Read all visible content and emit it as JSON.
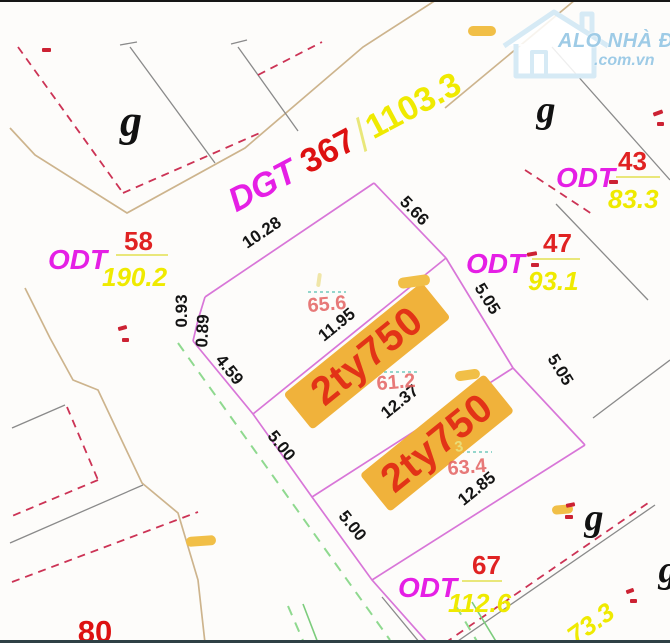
{
  "canvas": {
    "width": 670,
    "height": 643
  },
  "colors": {
    "parcel_code": "#e51fe5",
    "parcel_number": "#e02222",
    "parcel_area": "#efea00",
    "dimension_text": "#141414",
    "plot_line": "#d876d8",
    "road_line": "#cdb48d",
    "boundary_gray": "#8a8a8a",
    "red_dashed": "#cc3355",
    "green_survey": "#8fd98f",
    "teal_tick": "#72c9bd",
    "price_tag_bg": "#f0b23b",
    "price_tag_text": "#e23317",
    "watermark_blue": "#9ecbe6"
  },
  "watermark": {
    "brand": "ALO NHÀ ĐẤT",
    "domain": ".com.vn"
  },
  "road": {
    "code": "DGT",
    "number": "367",
    "area": "1103.3"
  },
  "parcels": [
    {
      "code": "ODT",
      "number": "58",
      "area": "190.2",
      "x": 48,
      "y": 244,
      "nx": 76,
      "ny": -18,
      "bx": 68,
      "by": 10,
      "bw": 52,
      "ax": 54,
      "ay": 18
    },
    {
      "code": "ODT",
      "number": "47",
      "area": "93.1",
      "x": 466,
      "y": 248,
      "nx": 77,
      "ny": -20,
      "bx": 66,
      "by": 10,
      "bw": 48,
      "ax": 62,
      "ay": 18
    },
    {
      "code": "ODT",
      "number": "43",
      "area": "83.3",
      "x": 556,
      "y": 162,
      "nx": 62,
      "ny": -16,
      "bx": 60,
      "by": 14,
      "bw": 44,
      "ax": 52,
      "ay": 22
    },
    {
      "code": "ODT",
      "number": "67",
      "area": "112.6",
      "x": 398,
      "y": 572,
      "nx": 74,
      "ny": -22,
      "bx": 64,
      "by": 8,
      "bw": 40,
      "ax": 50,
      "ay": 16
    }
  ],
  "price_tags": [
    {
      "label": "2ty750",
      "x": 367,
      "y": 356,
      "r": -39,
      "w": 178,
      "h": 46
    },
    {
      "label": "2ty750",
      "x": 437,
      "y": 443,
      "r": -39,
      "w": 160,
      "h": 48
    }
  ],
  "plot_areas": [
    {
      "v": "65.6",
      "x": 327,
      "y": 305,
      "r": -5
    },
    {
      "v": "61.2",
      "x": 396,
      "y": 383,
      "r": -5
    },
    {
      "v": "63.4",
      "x": 467,
      "y": 468,
      "r": -5
    }
  ],
  "dimensions": [
    {
      "v": "10.28",
      "x": 262,
      "y": 233,
      "r": -34
    },
    {
      "v": "5.66",
      "x": 414,
      "y": 211,
      "r": 46
    },
    {
      "v": "5.05",
      "x": 487,
      "y": 299,
      "r": 58
    },
    {
      "v": "5.05",
      "x": 560,
      "y": 370,
      "r": 58
    },
    {
      "v": "0.93",
      "x": 182,
      "y": 311,
      "r": -90
    },
    {
      "v": "0.89",
      "x": 203,
      "y": 331,
      "r": -87
    },
    {
      "v": "4.59",
      "x": 229,
      "y": 370,
      "r": 51
    },
    {
      "v": "5.00",
      "x": 281,
      "y": 446,
      "r": 51
    },
    {
      "v": "5.00",
      "x": 352,
      "y": 526,
      "r": 51
    },
    {
      "v": "11.95",
      "x": 337,
      "y": 325,
      "r": -39
    },
    {
      "v": "12.37",
      "x": 400,
      "y": 402,
      "r": -39
    },
    {
      "v": "12.85",
      "x": 477,
      "y": 489,
      "r": -39
    }
  ],
  "zone_letters": [
    {
      "v": "g",
      "x": 131,
      "y": 121,
      "s": 44
    },
    {
      "v": "g",
      "x": 546,
      "y": 110,
      "s": 38
    },
    {
      "v": "g",
      "x": 594,
      "y": 518,
      "s": 38
    },
    {
      "v": "g",
      "x": 668,
      "y": 570,
      "s": 38
    }
  ],
  "misc_labels": [
    {
      "v": "73.3",
      "x": 591,
      "y": 624,
      "r": -36,
      "cls": "ylabel"
    },
    {
      "v": "80",
      "x": 95,
      "y": 632,
      "r": 0,
      "cls": "rlabel"
    },
    {
      "v": "3",
      "x": 459,
      "y": 447,
      "r": -10,
      "cls": "p3"
    }
  ],
  "yellow_marks": [
    {
      "x": 468,
      "y": 26,
      "w": 28,
      "h": 10,
      "r": 0
    },
    {
      "x": 398,
      "y": 276,
      "w": 32,
      "h": 11,
      "r": -8
    },
    {
      "x": 455,
      "y": 370,
      "w": 25,
      "h": 10,
      "r": -8
    },
    {
      "x": 552,
      "y": 505,
      "w": 21,
      "h": 9,
      "r": -5
    },
    {
      "x": 186,
      "y": 536,
      "w": 30,
      "h": 10,
      "r": -4
    },
    {
      "x": 317,
      "y": 273,
      "w": 4,
      "h": 14,
      "r": 8,
      "c": "#f0e6a8"
    }
  ],
  "red_marks": [
    {
      "x": 42,
      "y": 48,
      "w": 9,
      "h": 4,
      "r": 0
    },
    {
      "x": 118,
      "y": 326,
      "w": 9,
      "h": 4,
      "r": -15
    },
    {
      "x": 122,
      "y": 338,
      "w": 7,
      "h": 4,
      "r": 0
    },
    {
      "x": 527,
      "y": 252,
      "w": 10,
      "h": 4,
      "r": -10
    },
    {
      "x": 531,
      "y": 263,
      "w": 8,
      "h": 4,
      "r": 0
    },
    {
      "x": 609,
      "y": 180,
      "w": 9,
      "h": 4,
      "r": 0
    },
    {
      "x": 653,
      "y": 111,
      "w": 10,
      "h": 4,
      "r": -20
    },
    {
      "x": 657,
      "y": 122,
      "w": 7,
      "h": 4,
      "r": 0
    },
    {
      "x": 566,
      "y": 503,
      "w": 9,
      "h": 4,
      "r": -12
    },
    {
      "x": 565,
      "y": 515,
      "w": 8,
      "h": 4,
      "r": 0
    },
    {
      "x": 626,
      "y": 589,
      "w": 8,
      "h": 4,
      "r": -20
    },
    {
      "x": 630,
      "y": 599,
      "w": 7,
      "h": 4,
      "r": 0
    }
  ]
}
